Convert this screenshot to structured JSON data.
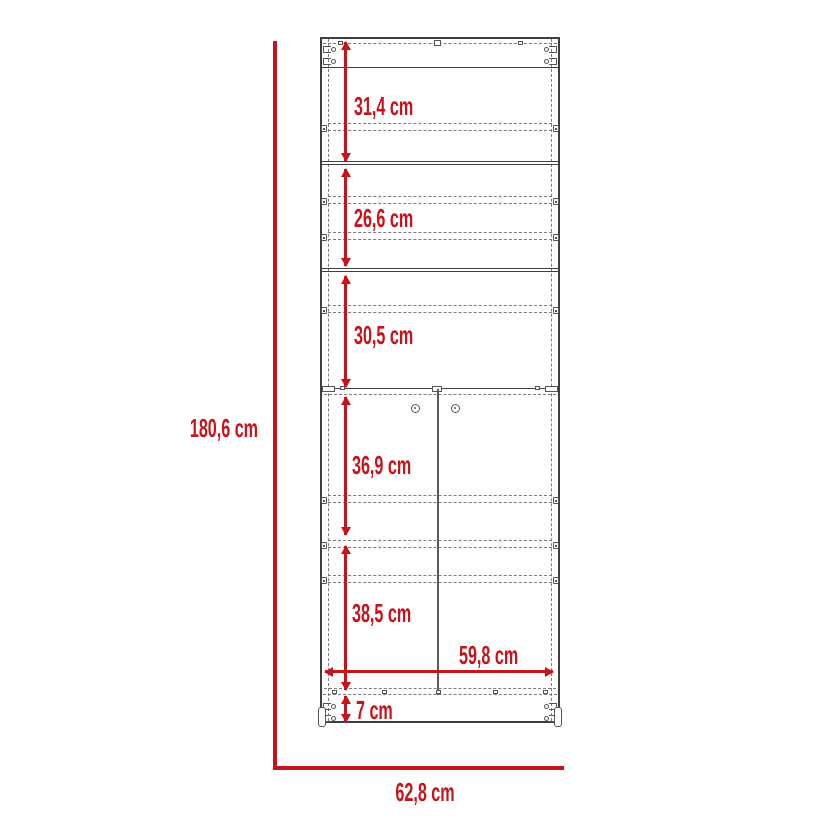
{
  "diagram": {
    "type": "furniture-dimension-drawing",
    "subject": "tall two-door cabinet with shelves, front elevation with dimensions",
    "unit": "cm",
    "overall": {
      "height_label": "180,6 cm",
      "width_label": "62,8 cm"
    },
    "inner_width_label": "59,8 cm",
    "sections": [
      {
        "name": "top-opening",
        "label": "31,4 cm"
      },
      {
        "name": "second-opening",
        "label": "26,6 cm"
      },
      {
        "name": "third-opening",
        "label": "30,5 cm"
      },
      {
        "name": "door-upper-compartment",
        "label": "36,9 cm"
      },
      {
        "name": "door-lower-compartment",
        "label": "38,5 cm"
      },
      {
        "name": "base-plinth",
        "label": "7 cm"
      }
    ],
    "icons": [
      "shelf-peg-icon",
      "cam-lock-icon",
      "hinge-tick-icon",
      "door-knob-icon",
      "foot-icon"
    ]
  },
  "colors": {
    "dimension_red": "#c6141a",
    "outline_dark": "#3f3f3f",
    "dashed_gray": "#7c7c7c",
    "hardware_gray": "#555555",
    "divider_gray": "#5a5a5a",
    "background": "#ffffff"
  }
}
